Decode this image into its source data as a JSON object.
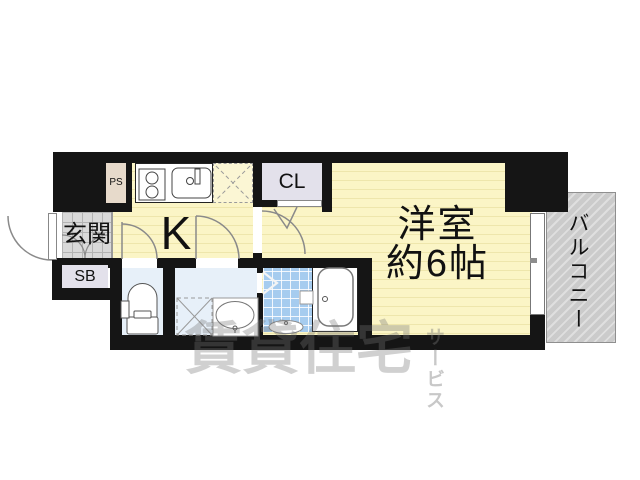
{
  "rooms": {
    "entrance": {
      "label": "玄関"
    },
    "kitchen": {
      "label": "K"
    },
    "closet": {
      "label": "CL"
    },
    "pipe_space": {
      "label": "PS"
    },
    "shoe_box": {
      "label": "SB"
    },
    "western_room": {
      "label": "洋室",
      "size": "約6帖"
    },
    "balcony": {
      "label": "バルコニー"
    }
  },
  "watermark": {
    "main": "賃貸住宅",
    "sub": "サービス"
  },
  "colors": {
    "wall": "#151515",
    "floor_yellow": "#FBF5C6",
    "floor_stripe": "#EEE6AC",
    "genkan_tile": "#D9D9D9",
    "water_room": "#E7F0F9",
    "bath_tile": "#A6CCEF",
    "closet_fill": "#E3E1EB",
    "pipe_space_fill": "#E7DACB",
    "balcony_fill": "#CBCBCB",
    "watermark_gray": "#767676"
  }
}
